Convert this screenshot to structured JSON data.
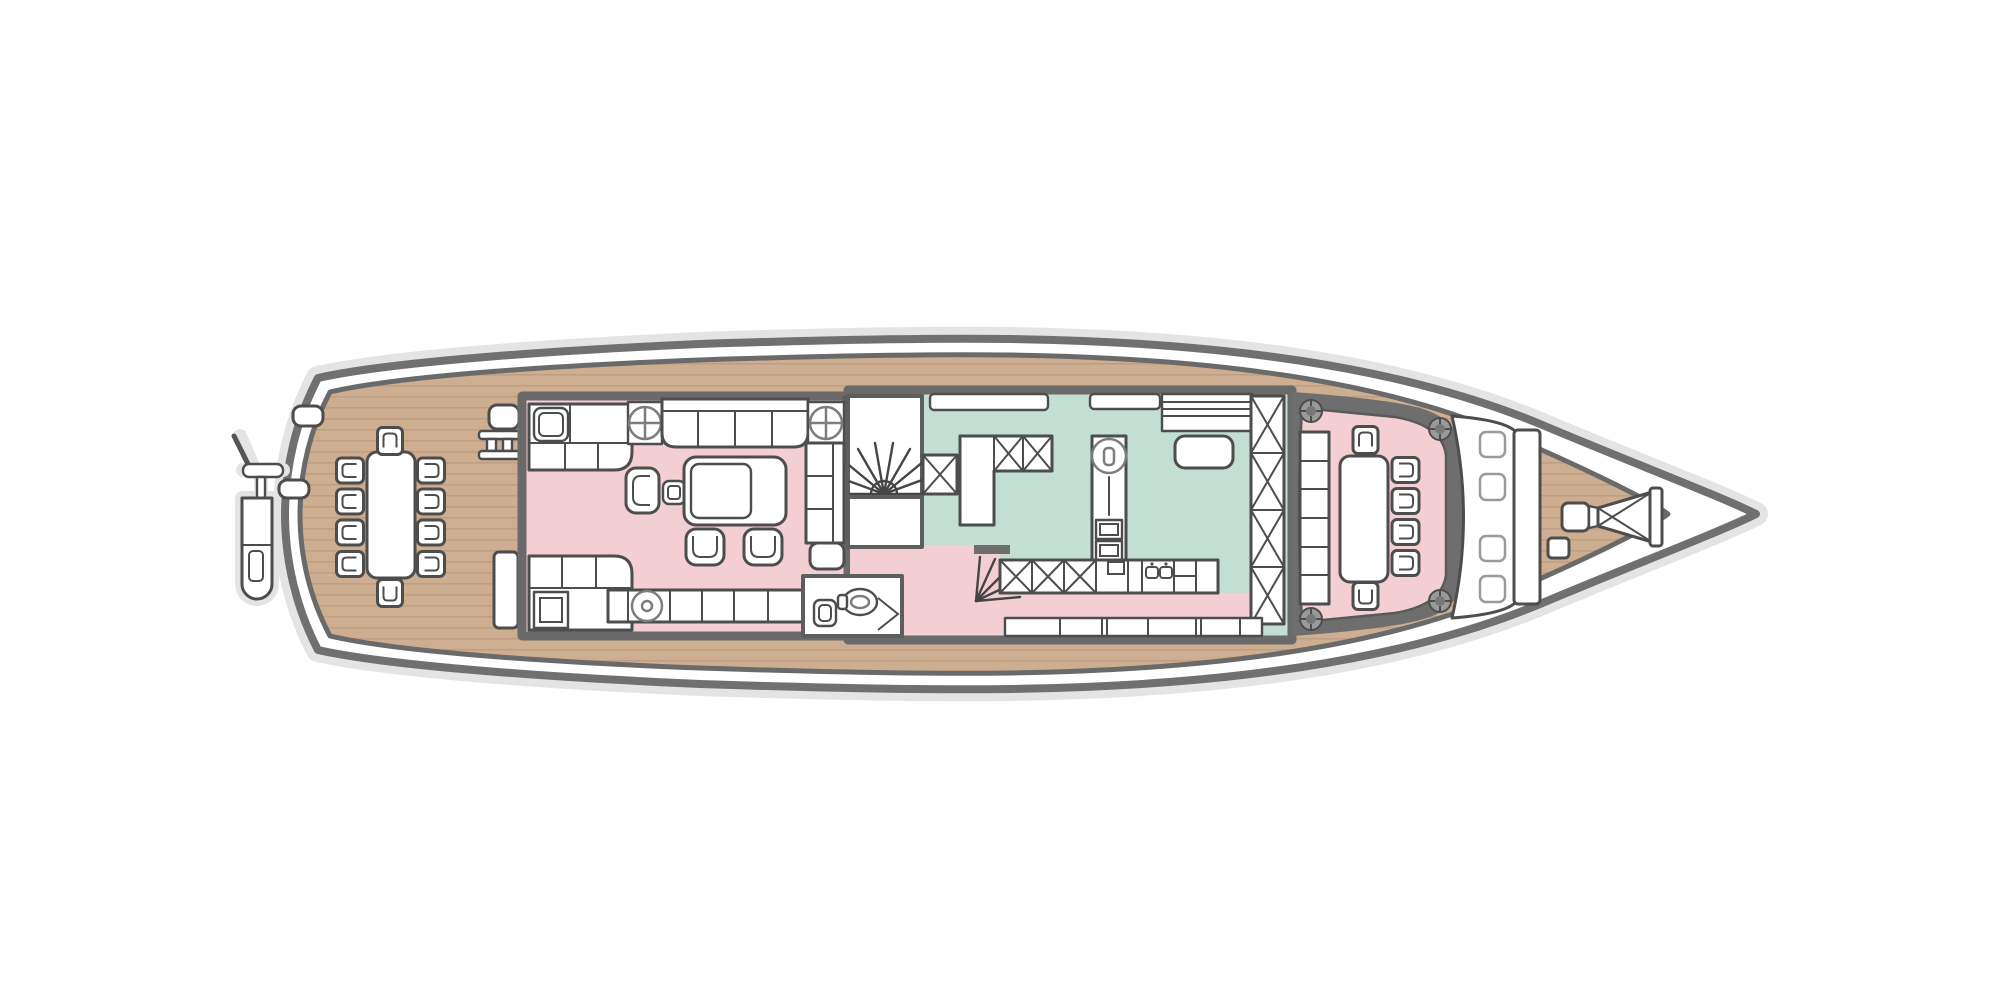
{
  "palette": {
    "page_bg": "#ffffff",
    "shadow": "#e4e4e4",
    "hull_line": "#707070",
    "hull_fill": "#ffffff",
    "deck_teak": "#ceae90",
    "plank_line": "#bf9f83",
    "bulwark_line": "#6a6a6a",
    "wall_gray": "#6a6a6a",
    "inner_wall": "#5e5e5e",
    "furniture_outline": "#4d4d4d",
    "furniture_fill": "#ffffff",
    "fixture_line": "#7d7d7d",
    "salon_pink": "#f3cfd3",
    "galley_mint": "#c3dfd4",
    "cockpit_pink": "#f3cfd3",
    "bolt_fill": "#9a9a9a",
    "stair_line": "#454545",
    "cushion_line": "#9a9a9a",
    "band_dark": "#6e6e6e"
  },
  "plan": {
    "type": "yacht-main-deck-floor-plan",
    "orientation": "bow-right",
    "areas": {
      "stern_gear": {
        "features": [
          "passerelle-gangway",
          "davit-pole",
          "boarding-ladder",
          "deck-cleats"
        ]
      },
      "aft_deck": {
        "floor": "teak-planks",
        "dining_table": 1,
        "dining_chairs": 10,
        "deck_bench": 1,
        "deck_box": 1
      },
      "salon": {
        "floor_color_key": "salon_pink",
        "furniture": [
          "corner-sofa-aft-port",
          "long-sofa-port",
          "side-sofa-starboard",
          "corner-sofa-aft-starboard",
          "pedestal-table-cross",
          "pedestal-table-cross",
          "pedestal-table-round",
          "armchair",
          "side-table",
          "coffee-table",
          "lounge-chair",
          "lounge-chair",
          "credenza"
        ]
      },
      "day_head": {
        "fixtures": [
          "washbasin",
          "toilet",
          "door"
        ]
      },
      "stairs": {
        "main_spiral_stair": 1,
        "crew_stair": 1,
        "dumbwaiter_x_box": 1
      },
      "galley": {
        "floor_color_key": "galley_mint",
        "features": [
          "island-with-cooktop",
          "ovens",
          "upper-x-cabinets",
          "lower-x-cabinets",
          "double-sink-counter",
          "appliance-counter",
          "tall-x-locker-column",
          "wall-niches",
          "window-band"
        ]
      },
      "forward_cockpit": {
        "floor_color_key": "cockpit_pink",
        "dining_table": 1,
        "dining_chairs": 6,
        "bench_seat_sections": 6,
        "corner_bolts": 4
      },
      "foredeck": {
        "floor": "teak-planks",
        "features": [
          "curved-bench",
          "bench-cushions",
          "backrest-board",
          "windlass-bowsprit",
          "cleat"
        ]
      }
    }
  }
}
